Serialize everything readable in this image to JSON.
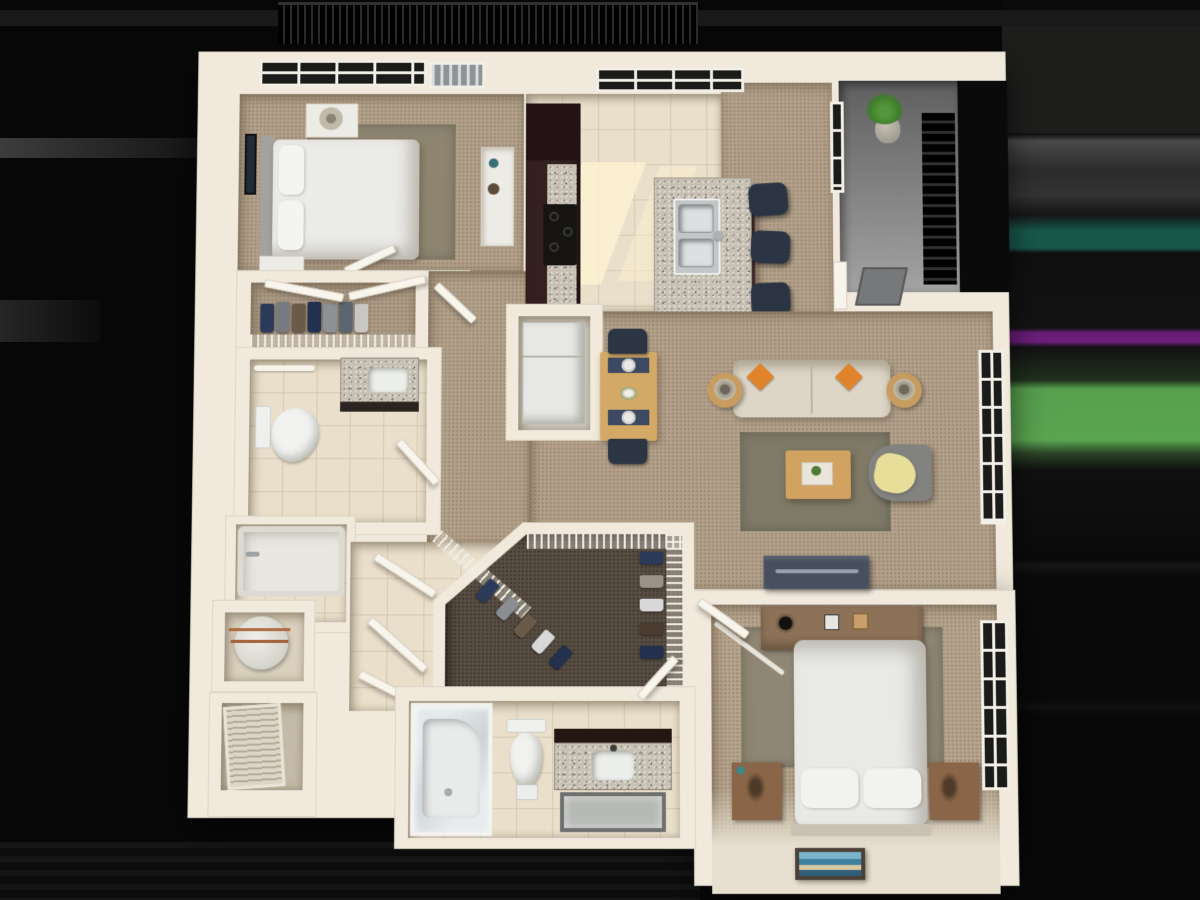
{
  "scene": {
    "kind": "3d-rendered-floor-plan",
    "view": "top-down dollhouse render",
    "unit": "one-bedroom-plus-den style apartment, two baths",
    "background_color": "#070707"
  },
  "palette": {
    "wall_cream": "#f0e9dc",
    "carpet_tan": "#b2a08a",
    "tile_beige": "#e9dfcb",
    "rug_olive": "#7f7a68",
    "granite_speckle": "#c7c1b5",
    "cabinet_espresso": "#34211f",
    "navy_seat": "#2b3544",
    "accent_orange": "#e0832a",
    "accent_yellow_throw": "#e7de99",
    "plant_green": "#4f8f35",
    "balcony_black": "#0c0c0c",
    "porch_gray": "#8f8f8f",
    "streak_teal": "#17584a",
    "streak_purple": "#6a1e79",
    "streak_green": "#57a04e"
  },
  "rooms": [
    {
      "id": "bedroom-2",
      "label": "Bedroom 2 (top left)",
      "floor": "carpet"
    },
    {
      "id": "closet-1",
      "label": "Reach-in closet with sliding doors",
      "floor": "carpet"
    },
    {
      "id": "vestibule",
      "label": "Bedroom hall / vestibule",
      "floor": "carpet"
    },
    {
      "id": "bathroom-1",
      "label": "Bathroom 1",
      "floor": "tile"
    },
    {
      "id": "tub-room",
      "label": "Tub alcove",
      "floor": "tile"
    },
    {
      "id": "utility-closet",
      "label": "Water-heater closet",
      "floor": "tile"
    },
    {
      "id": "laundry-closet",
      "label": "Louvered-door closet",
      "floor": "tile"
    },
    {
      "id": "hall",
      "label": "Lower hall with open doors",
      "floor": "tile"
    },
    {
      "id": "kitchen",
      "label": "Kitchen with island",
      "floor": "tile"
    },
    {
      "id": "dining",
      "label": "Dining area",
      "floor": "carpet"
    },
    {
      "id": "living",
      "label": "Living room",
      "floor": "carpet"
    },
    {
      "id": "walkin-closet",
      "label": "Walk-in closet",
      "floor": "dark carpet"
    },
    {
      "id": "bathroom-2",
      "label": "Bathroom 2 with shower",
      "floor": "tile"
    },
    {
      "id": "bedroom-1",
      "label": "Master bedroom (bottom right)",
      "floor": "carpet"
    },
    {
      "id": "entry-porch",
      "label": "Entry porch with stair",
      "floor": "concrete gray"
    },
    {
      "id": "balcony",
      "label": "Balcony with black railing",
      "floor": "outdoor"
    }
  ],
  "furniture": {
    "bedroom_2": [
      "queen bed with white duvet",
      "gray headboard",
      "two nightstands with lamps",
      "framed wall art",
      "dresser with vases",
      "olive rug",
      "double window",
      "balcony door"
    ],
    "kitchen": [
      "espresso cabinet run",
      "black range with burners",
      "granite counter",
      "granite island with double stainless sink",
      "three navy bar stools",
      "triple window",
      "sunlight patches"
    ],
    "dining": [
      "wood dining table",
      "two navy chairs",
      "navy placemats with white plates",
      "flower centerpiece",
      "refrigerator nook with white fridge"
    ],
    "living": [
      "beige sofa",
      "two orange accent pillows",
      "two round wood side tables with lamps",
      "olive area rug",
      "wood coffee table with tray plant",
      "gray armchair with yellow throw",
      "navy media console",
      "tall right-wall window"
    ],
    "bathroom_1": [
      "toilet",
      "granite-top vanity with sink",
      "towel bar",
      "swing door"
    ],
    "tub_room": [
      "bathtub with faucet"
    ],
    "utility_closet": [
      "round water heater with copper piping"
    ],
    "laundry_closet": [
      "louvered bifold door"
    ],
    "walkin_closet": [
      "wire shelving on three walls",
      "hanging clothes in navy gray brown white",
      "bifold entry doors"
    ],
    "bathroom_2": [
      "glass shower stall",
      "toilet",
      "espresso vanity with granite top and sink",
      "framed mirror",
      "swing door"
    ],
    "bedroom_1": [
      "queen bed with white duvet and two pillows",
      "two wood nightstands with lamps",
      "low dresser with decor",
      "olive rug",
      "floor-leaning framed art",
      "ceiling-fan blade glint",
      "tall right-wall window"
    ],
    "entry_porch": [
      "potted plant",
      "black stair railing",
      "front door",
      "gray doormat",
      "sidelight window"
    ]
  },
  "background_bands": [
    "#1d1d1c",
    "#4a4a4a",
    "#17584a",
    "#6a1e79",
    "#57a04e",
    "#151515"
  ]
}
